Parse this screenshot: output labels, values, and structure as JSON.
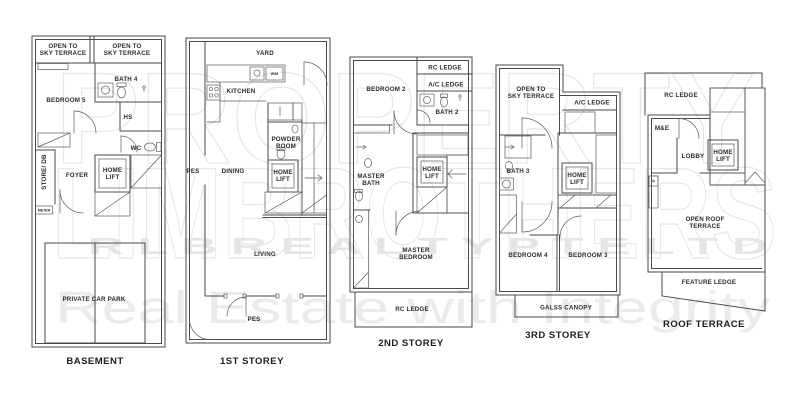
{
  "colors": {
    "wall": "#4a4a4a",
    "label": "#2b2b2b",
    "watermark": "#e7e7e7"
  },
  "watermark": {
    "line1": "PROPERTY",
    "line2": "LIMBROTHERS",
    "line3": "R L B   R E A L T Y   P T E   L T D",
    "line4": "Real Estate with Integrity"
  },
  "plans": {
    "basement": {
      "title": "BASEMENT",
      "labels": {
        "open_sky_left_1": "OPEN TO",
        "open_sky_left_2": "SKY TERRACE",
        "open_sky_right_1": "OPEN TO",
        "open_sky_right_2": "SKY TERRACE",
        "bath4": "BATH 4",
        "bedroom5": "BEDROOM 5",
        "hs": "HS",
        "wc": "WC",
        "store_db": "STORE/ DB",
        "foyer": "FOYER",
        "home_lift_1": "HOME",
        "home_lift_2": "LIFT",
        "meter": "METER",
        "car_park": "PRIVATE CAR PARK"
      }
    },
    "first": {
      "title": "1ST STOREY",
      "labels": {
        "yard": "YARD",
        "wm": "W/M",
        "kitchen": "KITCHEN",
        "powder_1": "POWDER",
        "powder_2": "ROOM",
        "pes_left": "PES",
        "dining": "DINING",
        "home_lift_1": "HOME",
        "home_lift_2": "LIFT",
        "living": "LIVING",
        "pes_bottom": "PES"
      }
    },
    "second": {
      "title": "2ND STOREY",
      "labels": {
        "bedroom2": "BEDROOM 2",
        "rc_ledge_top": "RC LEDGE",
        "ac_ledge": "A/C LEDGE",
        "bath2": "BATH 2",
        "master_bath_1": "MASTER",
        "master_bath_2": "BATH",
        "home_lift_1": "HOME",
        "home_lift_2": "LIFT",
        "master_bedroom_1": "MASTER",
        "master_bedroom_2": "BEDROOM",
        "rc_ledge_bottom": "RC LEDGE"
      }
    },
    "third": {
      "title": "3RD STOREY",
      "labels": {
        "open_sky_1": "OPEN TO",
        "open_sky_2": "SKY TERRACE",
        "ac_ledge": "A/C LEDGE",
        "bath3": "BATH 3",
        "home_lift_1": "HOME",
        "home_lift_2": "LIFT",
        "bedroom4": "BEDROOM 4",
        "bedroom3": "BEDROOM 3",
        "glass_canopy": "GALSS CANOPY"
      }
    },
    "roof": {
      "title": "ROOF TERRACE",
      "labels": {
        "rc_ledge": "RC LEDGE",
        "me": "M&E",
        "lobby": "LOBBY",
        "home_lift_1": "HOME",
        "home_lift_2": "LIFT",
        "open_roof_1": "OPEN ROOF",
        "open_roof_2": "TERRACE",
        "feature_ledge": "FEATURE LEDGE"
      }
    }
  }
}
